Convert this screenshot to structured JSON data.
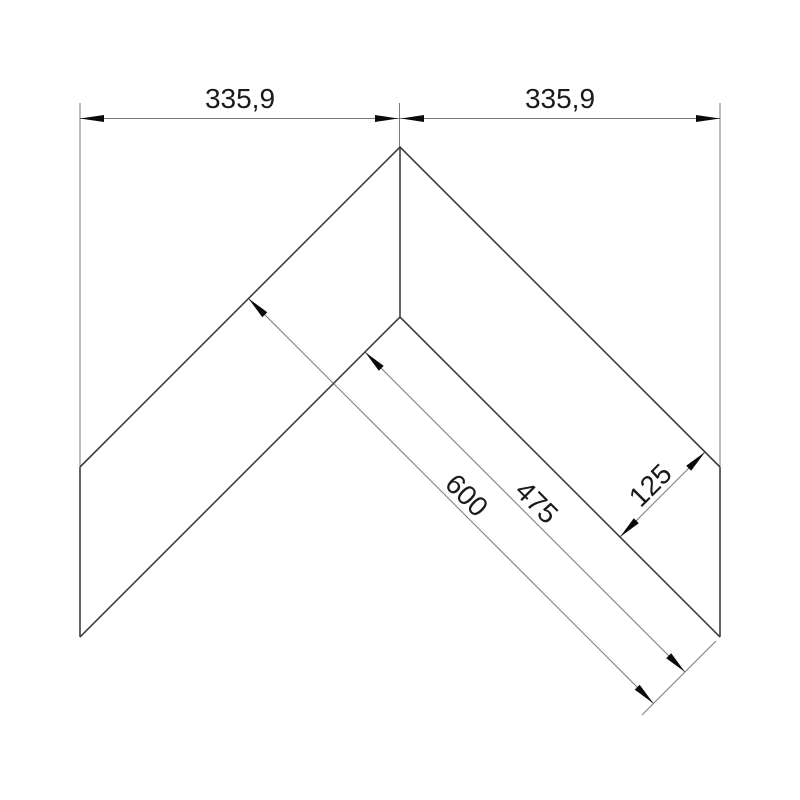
{
  "drawing": {
    "description": "Technical dimension drawing of a 90-degree corner profile (chevron shape) with two equal legs",
    "labels": {
      "top_left_width": "335,9",
      "top_right_width": "335,9",
      "outer_leg_length": "600",
      "inner_leg_length": "475",
      "profile_width": "125"
    },
    "colors": {
      "background": "#ffffff",
      "object_line": "#3f3f3f",
      "dimension_line": "#7a7a7a",
      "arrow": "#0a0a0a",
      "text": "#1a1a1a"
    }
  }
}
